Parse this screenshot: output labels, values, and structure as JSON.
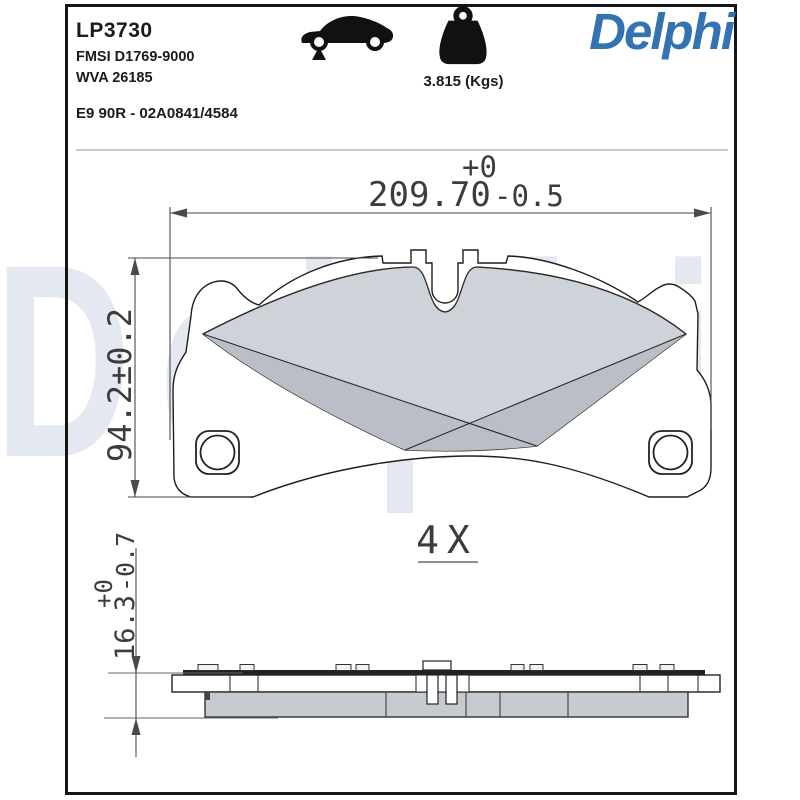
{
  "colors": {
    "brand_blue": "#3473b2",
    "pad_light": "#ced3da",
    "pad_dark": "#b9bec7",
    "friction_side": "#c6cad1",
    "watermark": "#e4e9f1",
    "line": "#3c3c3c"
  },
  "header": {
    "part_number": "LP3730",
    "fmsi": "FMSI D1769-9000",
    "wva": "WVA 26185",
    "approval": "E9 90R - 02A0841/4584",
    "weight": "3.815 (Kgs)",
    "brand": "Delphi",
    "car_icon": "car-silhouette",
    "weight_icon": "kettlebell-weight"
  },
  "watermark_text": "Delphi",
  "front_view": {
    "dim_width": {
      "value": "209.70",
      "tol_plus": "+0",
      "tol_minus": "-0.5"
    },
    "dim_height": {
      "value": "94.2±0.2"
    },
    "quantity_label": "4X"
  },
  "side_view": {
    "dim_thickness": {
      "value": "16.3",
      "tol_plus": "+0",
      "tol_minus": "-0.7"
    }
  }
}
